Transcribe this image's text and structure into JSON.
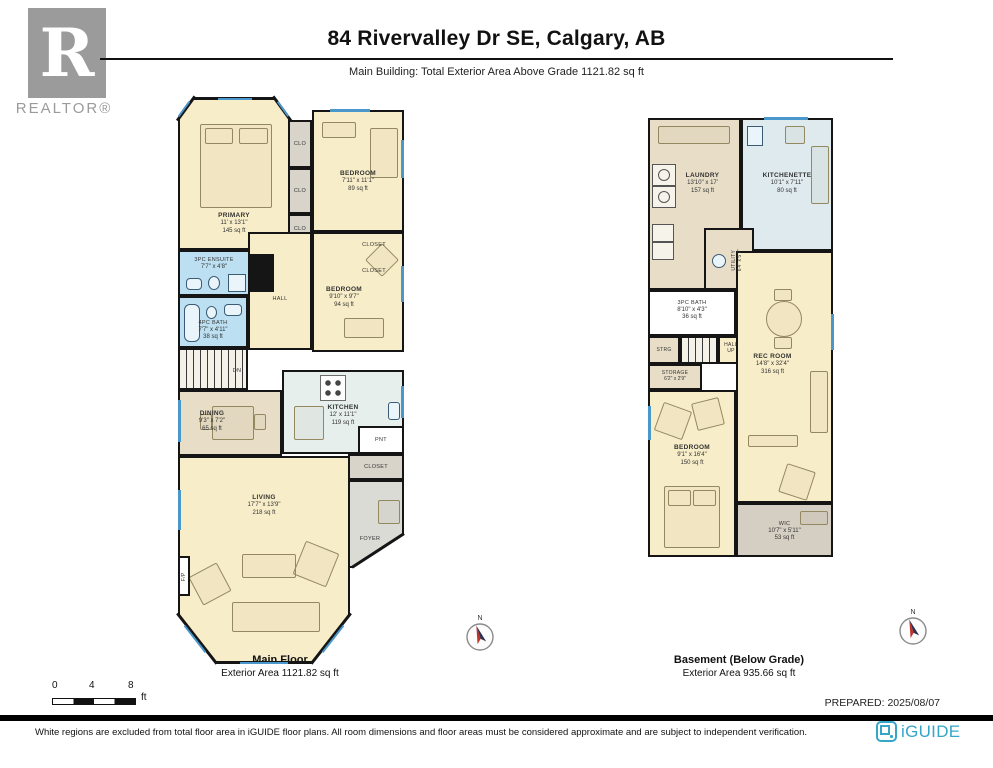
{
  "colors": {
    "wall": "#151515",
    "room_beige": "#F8EDC9",
    "wet_area_blue": "#BCE0F2",
    "closet_gray": "#D9D4C9",
    "dining_tan": "#E8DEC7",
    "kitchen_pale": "#E6EFEC",
    "window_blue": "#4A97CC",
    "brand_teal": "#35A5C8",
    "realtor_gray": "#9B9B9B"
  },
  "header": {
    "title": "84 Rivervalley Dr SE, Calgary, AB",
    "subtitle": "Main Building: Total Exterior Area Above Grade 1121.82 sq ft",
    "realtor": {
      "letter": "R",
      "label": "REALTOR®"
    }
  },
  "main_floor": {
    "caption": {
      "name": "Main Floor",
      "area": "Exterior Area 1121.82 sq ft"
    },
    "rooms": {
      "primary": {
        "name": "PRIMARY",
        "dims": "11' x 13'1\"",
        "area": "145 sq ft"
      },
      "bedroom2": {
        "name": "BEDROOM",
        "dims": "7'11\" x 11'1\"",
        "area": "89 sq ft"
      },
      "bedroom3": {
        "name": "BEDROOM",
        "dims": "9'10\" x 9'7\"",
        "area": "94 sq ft"
      },
      "ensuite": {
        "name": "3PC ENSUITE",
        "dims": "7'7\" x 4'8\""
      },
      "bath": {
        "name": "4PC BATH",
        "dims": "7'7\" x 4'11\"",
        "area": "38 sq ft"
      },
      "kitchen": {
        "name": "KITCHEN",
        "dims": "12' x 11'1\"",
        "area": "119 sq ft"
      },
      "dining": {
        "name": "DINING",
        "dims": "9'3\" x 7'2\"",
        "area": "65 sq ft"
      },
      "living": {
        "name": "LIVING",
        "dims": "17'7\" x 13'9\"",
        "area": "218 sq ft"
      },
      "hall": {
        "name": "HALL"
      },
      "foyer": {
        "name": "FOYER"
      },
      "pantry": {
        "name": "PNT"
      },
      "clo": {
        "name": "CLO"
      },
      "closet": {
        "name": "CLOSET"
      },
      "fireplace": {
        "name": "F/P"
      },
      "stairs_down": {
        "name": "DN"
      }
    }
  },
  "basement": {
    "caption": {
      "name": "Basement (Below Grade)",
      "area": "Exterior Area 935.66 sq ft"
    },
    "rooms": {
      "laundry": {
        "name": "LAUNDRY",
        "dims": "13'10\" x 17'",
        "area": "157 sq ft"
      },
      "kitchenette": {
        "name": "KITCHENETTE",
        "dims": "10'1\" x 7'11\"",
        "area": "80 sq ft"
      },
      "utility": {
        "name": "UTILITY",
        "dims": "6'4\" x 5'7\""
      },
      "bath": {
        "name": "3PC BATH",
        "dims": "8'10\" x 4'3\"",
        "area": "36 sq ft"
      },
      "strg": {
        "name": "STRG"
      },
      "hall_up": {
        "name": "HALL UP"
      },
      "storage": {
        "name": "STORAGE",
        "dims": "6'2\" x 2'9\""
      },
      "rec_room": {
        "name": "REC ROOM",
        "dims": "14'8\" x 32'4\"",
        "area": "316 sq ft"
      },
      "bedroom": {
        "name": "BEDROOM",
        "dims": "9'1\" x 16'4\"",
        "area": "150 sq ft"
      },
      "wic": {
        "name": "WIC",
        "dims": "10'7\" x 5'11\"",
        "area": "53 sq ft"
      }
    }
  },
  "scale_bar": {
    "ticks": [
      "0",
      "4",
      "8"
    ],
    "unit": "ft"
  },
  "compass": {
    "north": "N"
  },
  "prepared_label": "PREPARED: 2025/08/07",
  "footer": {
    "disclaimer": "White regions are excluded from total floor area in iGUIDE floor plans. All room dimensions and floor areas must be considered approximate and are subject to independent verification.",
    "brand": "iGUIDE"
  }
}
